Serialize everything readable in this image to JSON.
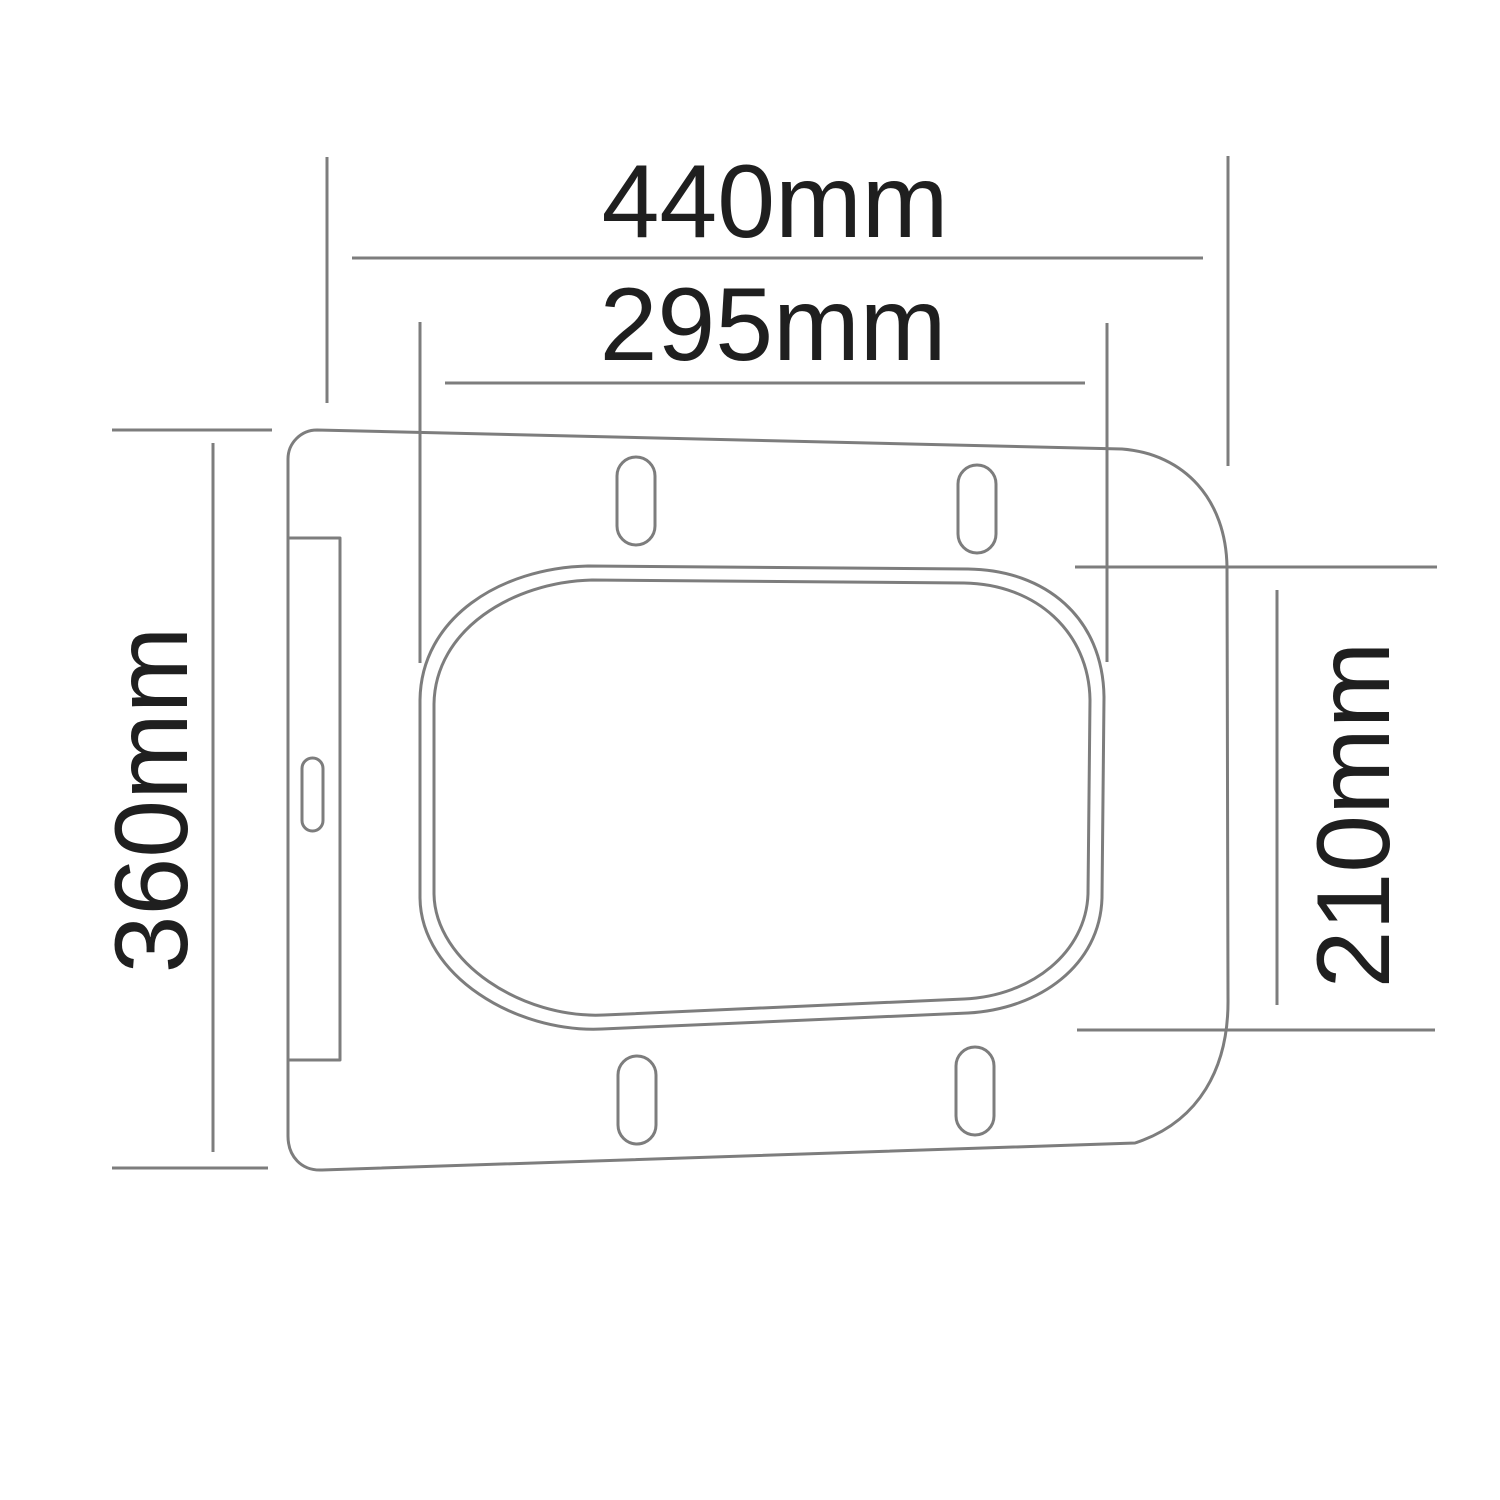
{
  "drawing": {
    "subject": "toilet-seat-top-view-technical-drawing",
    "background": "#ffffff",
    "line_color": "#7d7d7d",
    "text_color": "#1f1f1f",
    "dimensions": {
      "overall_width": {
        "label": "440mm",
        "value": 440,
        "unit": "mm",
        "orientation": "horizontal"
      },
      "opening_width": {
        "label": "295mm",
        "value": 295,
        "unit": "mm",
        "orientation": "horizontal"
      },
      "overall_depth": {
        "label": "360mm",
        "value": 360,
        "unit": "mm",
        "orientation": "vertical"
      },
      "opening_depth": {
        "label": "210mm",
        "value": 210,
        "unit": "mm",
        "orientation": "vertical"
      }
    }
  }
}
